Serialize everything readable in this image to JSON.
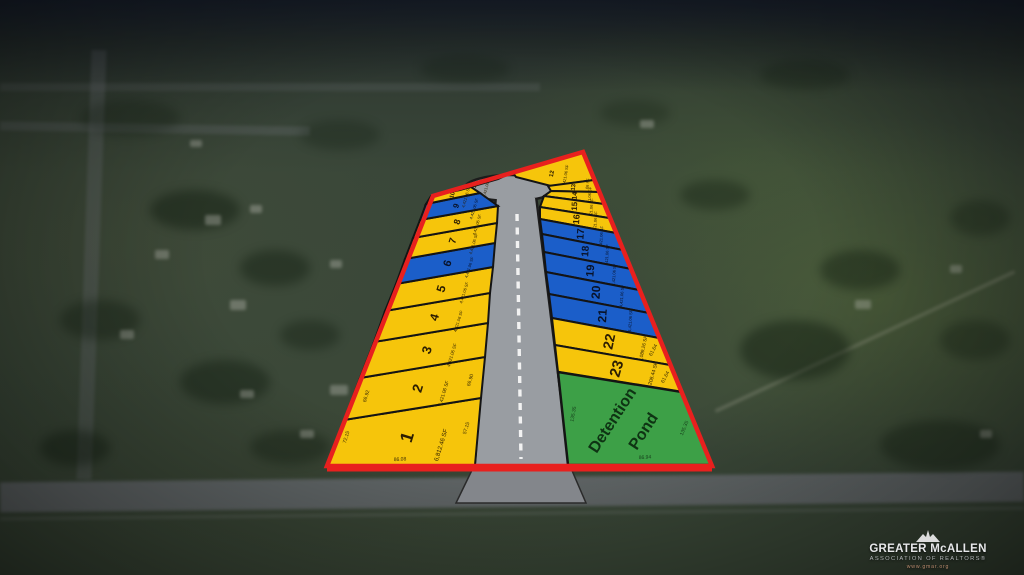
{
  "colors": {
    "lot_yellow": "#f6c50b",
    "lot_blue": "#1b5ec9",
    "pond_green": "#3da047",
    "boundary_red": "#e8201e",
    "road_gray": "#999da2",
    "road_apron_gray": "#83868b",
    "lot_stroke": "#141414",
    "num_on_yellow": "#2b1d02",
    "num_on_blue": "#081228",
    "pond_text": "#0e3313",
    "dim_on_yellow": "#3a2b06",
    "dim_on_green": "#17401c",
    "centerline_white": "#f2f2f2"
  },
  "plat": {
    "boundary": [
      [
        327,
        466
      ],
      [
        433,
        196
      ],
      [
        583,
        152
      ],
      [
        712,
        466
      ]
    ],
    "road": {
      "stem": [
        [
          476,
          464
        ],
        [
          497,
          198
        ],
        [
          535,
          198
        ],
        [
          568,
          464
        ]
      ],
      "bulb": {
        "cx": 511,
        "cy": 188,
        "rx": 46,
        "ry": 13
      },
      "apron": [
        [
          474,
          466
        ],
        [
          570,
          466
        ],
        [
          586,
          503
        ],
        [
          456,
          503
        ]
      ],
      "centerline": {
        "x1": 517,
        "y1": 214,
        "x2": 521,
        "y2": 459
      }
    },
    "lots": [
      {
        "num": "1",
        "color": "yellow",
        "area": "6,812.46 SF",
        "rot": -73,
        "size": 18,
        "adx": 34,
        "ady": 8,
        "poly": [
          [
            327,
            465
          ],
          [
            344,
            420
          ],
          [
            481,
            398
          ],
          [
            475,
            465
          ]
        ]
      },
      {
        "num": "2",
        "color": "yellow",
        "area": "4,421.06 SF",
        "rot": -73,
        "size": 14,
        "adx": 26,
        "ady": 5,
        "poly": [
          [
            344,
            420
          ],
          [
            360,
            378
          ],
          [
            485,
            357
          ],
          [
            481,
            398
          ]
        ]
      },
      {
        "num": "3",
        "color": "yellow",
        "area": "4,421.06 SF",
        "rot": -73,
        "size": 13,
        "adx": 25,
        "ady": 5,
        "poly": [
          [
            360,
            378
          ],
          [
            374,
            342
          ],
          [
            488,
            323
          ],
          [
            485,
            357
          ]
        ]
      },
      {
        "num": "4",
        "color": "yellow",
        "area": "4,421.06 SF",
        "rot": -73,
        "size": 12,
        "adx": 24,
        "ady": 4,
        "poly": [
          [
            374,
            342
          ],
          [
            385,
            311
          ],
          [
            490,
            293
          ],
          [
            488,
            323
          ]
        ]
      },
      {
        "num": "5",
        "color": "yellow",
        "area": "4,421.06 SF",
        "rot": -73,
        "size": 12,
        "adx": 23,
        "ady": 4,
        "poly": [
          [
            385,
            311
          ],
          [
            396,
            284
          ],
          [
            493,
            267
          ],
          [
            490,
            293
          ]
        ]
      },
      {
        "num": "6",
        "color": "blue",
        "area": "4,421.06 SF",
        "rot": -73,
        "size": 11,
        "adx": 22,
        "ady": 4,
        "poly": [
          [
            396,
            284
          ],
          [
            405,
            259
          ],
          [
            495,
            243
          ],
          [
            493,
            267
          ]
        ]
      },
      {
        "num": "7",
        "color": "yellow",
        "area": "4,421.06 SF",
        "rot": -73,
        "size": 10,
        "adx": 21,
        "ady": 3,
        "poly": [
          [
            405,
            259
          ],
          [
            413,
            238
          ],
          [
            497,
            223
          ],
          [
            495,
            243
          ]
        ]
      },
      {
        "num": "8",
        "color": "yellow",
        "area": "4,421.06 SF",
        "rot": -73,
        "size": 9,
        "adx": 20,
        "ady": 3,
        "poly": [
          [
            413,
            238
          ],
          [
            420,
            220
          ],
          [
            498,
            206
          ],
          [
            497,
            223
          ]
        ]
      },
      {
        "num": "9",
        "color": "blue",
        "area": "4,421.06 SF",
        "rot": -73,
        "size": 8,
        "adx": 18,
        "ady": 3,
        "poly": [
          [
            420,
            220
          ],
          [
            426,
            204
          ],
          [
            480,
            193
          ],
          [
            498,
            206
          ]
        ]
      },
      {
        "num": "10",
        "color": "yellow",
        "area": "4,421.06 SF",
        "rot": -74,
        "size": 6,
        "adx": 14,
        "ady": 2,
        "poly": [
          [
            426,
            204
          ],
          [
            431,
            196
          ],
          [
            471,
            187
          ],
          [
            480,
            193
          ]
        ]
      },
      {
        "num": "11",
        "color": "yellow",
        "area": "4,421.06 SF",
        "rot": -75,
        "size": 6,
        "adx": 12,
        "ady": 2,
        "poly": [
          [
            431,
            196
          ],
          [
            509,
            174
          ],
          [
            498,
            179
          ],
          [
            460,
            190
          ]
        ]
      },
      {
        "num": "12",
        "color": "yellow",
        "area": "4,421.06 SF",
        "rot": -80,
        "size": 6,
        "adx": 14,
        "ady": 2,
        "poly": [
          [
            513,
            173
          ],
          [
            583,
            152
          ],
          [
            594,
            180
          ],
          [
            551,
            186
          ],
          [
            516,
            177
          ]
        ]
      },
      {
        "num": "13",
        "color": "yellow",
        "area": "4,421.06 SF",
        "rot": -84,
        "size": 6,
        "adx": 14,
        "ady": 2,
        "poly": [
          [
            548,
            186
          ],
          [
            594,
            180
          ],
          [
            599,
            192
          ],
          [
            551,
            191
          ]
        ]
      },
      {
        "num": "14",
        "color": "yellow",
        "area": "4,421.06 SF",
        "rot": -86,
        "size": 7,
        "adx": 15,
        "ady": 2,
        "poly": [
          [
            551,
            191
          ],
          [
            599,
            192
          ],
          [
            604,
            204
          ],
          [
            544,
            196
          ]
        ]
      },
      {
        "num": "15",
        "color": "yellow",
        "area": "4,421.06 SF",
        "rot": -86,
        "size": 8,
        "adx": 17,
        "ady": 3,
        "poly": [
          [
            544,
            196
          ],
          [
            604,
            204
          ],
          [
            609,
            218
          ],
          [
            540,
            207
          ]
        ]
      },
      {
        "num": "16",
        "color": "yellow",
        "area": "4,421.06 SF",
        "rot": -86,
        "size": 9,
        "adx": 19,
        "ady": 3,
        "poly": [
          [
            540,
            207
          ],
          [
            609,
            218
          ],
          [
            616,
            233
          ],
          [
            540,
            219
          ]
        ]
      },
      {
        "num": "17",
        "color": "blue",
        "area": "4,421.06 SF",
        "rot": -86,
        "size": 10,
        "adx": 21,
        "ady": 3,
        "poly": [
          [
            540,
            219
          ],
          [
            616,
            233
          ],
          [
            623,
            250
          ],
          [
            542,
            234
          ]
        ]
      },
      {
        "num": "18",
        "color": "blue",
        "area": "4,421.06 SF",
        "rot": -86,
        "size": 10,
        "adx": 22,
        "ady": 4,
        "poly": [
          [
            542,
            234
          ],
          [
            623,
            250
          ],
          [
            631,
            269
          ],
          [
            544,
            252
          ]
        ]
      },
      {
        "num": "19",
        "color": "blue",
        "area": "4,421.06 SF",
        "rot": -86,
        "size": 11,
        "adx": 24,
        "ady": 4,
        "poly": [
          [
            544,
            252
          ],
          [
            631,
            269
          ],
          [
            639,
            290
          ],
          [
            546,
            272
          ]
        ]
      },
      {
        "num": "20",
        "color": "blue",
        "area": "4,421.06 SF",
        "rot": -86,
        "size": 12,
        "adx": 26,
        "ady": 4,
        "poly": [
          [
            546,
            272
          ],
          [
            639,
            290
          ],
          [
            649,
            313
          ],
          [
            549,
            294
          ]
        ]
      },
      {
        "num": "21",
        "color": "blue",
        "area": "4,421.06 SF",
        "rot": -86,
        "size": 12,
        "adx": 28,
        "ady": 5,
        "poly": [
          [
            549,
            294
          ],
          [
            649,
            313
          ],
          [
            659,
            338
          ],
          [
            552,
            318
          ]
        ]
      },
      {
        "num": "22",
        "color": "yellow",
        "area": "6,089.26 SF",
        "rot": -78,
        "size": 14,
        "adx": 34,
        "ady": 7,
        "poly": [
          [
            552,
            318
          ],
          [
            659,
            338
          ],
          [
            670,
            365
          ],
          [
            555,
            345
          ]
        ]
      },
      {
        "num": "23",
        "color": "yellow",
        "area": "6,208.44 SF",
        "rot": -74,
        "size": 15,
        "adx": 36,
        "ady": 7,
        "poly": [
          [
            555,
            345
          ],
          [
            670,
            365
          ],
          [
            682,
            392
          ],
          [
            558,
            372
          ]
        ]
      }
    ],
    "pond": {
      "label_line1": "Detention",
      "label_line2": "Pond",
      "rot": -57,
      "poly": [
        [
          558,
          372
        ],
        [
          682,
          392
        ],
        [
          712,
          465
        ],
        [
          568,
          465
        ]
      ]
    },
    "dims": [
      {
        "t": "72.15",
        "x": 346,
        "y": 437,
        "r": -73,
        "on": "yellow"
      },
      {
        "t": "57.15",
        "x": 466,
        "y": 428,
        "r": -73,
        "on": "yellow"
      },
      {
        "t": "86.08",
        "x": 400,
        "y": 459,
        "r": -4,
        "on": "yellow"
      },
      {
        "t": "66.92",
        "x": 366,
        "y": 396,
        "r": -73,
        "on": "yellow"
      },
      {
        "t": "66.90",
        "x": 470,
        "y": 380,
        "r": -73,
        "on": "yellow"
      },
      {
        "t": "61.64",
        "x": 653,
        "y": 350,
        "r": -62,
        "on": "yellow"
      },
      {
        "t": "61.64",
        "x": 665,
        "y": 377,
        "r": -62,
        "on": "yellow"
      },
      {
        "t": "135.35",
        "x": 573,
        "y": 414,
        "r": -80,
        "on": "green"
      },
      {
        "t": "135.35",
        "x": 684,
        "y": 428,
        "r": -68,
        "on": "green"
      },
      {
        "t": "86.94",
        "x": 645,
        "y": 457,
        "r": -4,
        "on": "green"
      }
    ]
  },
  "logo": {
    "name": "GREATER McALLEN",
    "subtitle": "ASSOCIATION OF REALTORS®",
    "url": "www.gmar.org"
  }
}
